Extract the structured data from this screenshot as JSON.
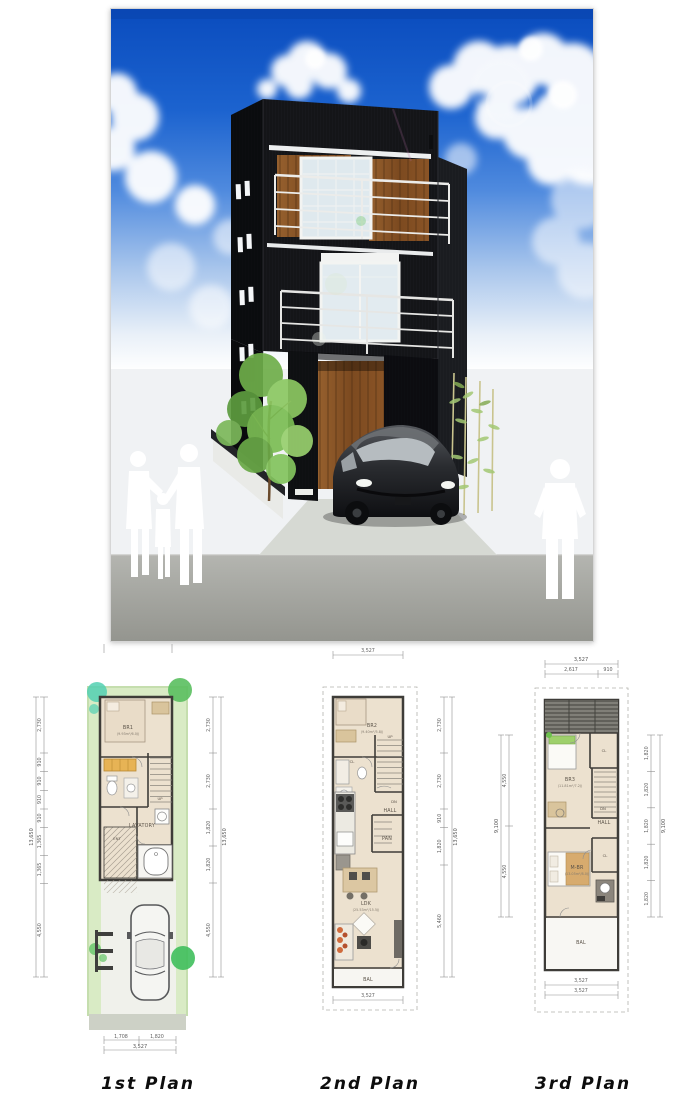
{
  "page": {
    "background": "#ffffff"
  },
  "rendering": {
    "subject": "three-story modern black house exterior with car and people silhouettes",
    "colors": {
      "sky_top": "#0a4cbe",
      "sky_mid": "#4f8ade",
      "building_black": "#17181c",
      "wood_accent": "#8c5426",
      "glass": "#dce8ee",
      "railing": "#ececea",
      "street_gray": "#a4a5a0",
      "foliage_green": "#7bbd54"
    }
  },
  "plans": [
    {
      "title": "1st Plan",
      "labels": {
        "br": "BR1",
        "br_size": "(9.93m²/6.0J)",
        "lavatory": "LAVATORY",
        "ent": "ENT",
        "up": "UP"
      },
      "dims": {
        "left": [
          "2,730",
          "910",
          "910",
          "910",
          "910",
          "1,365",
          "1,365",
          "4,550"
        ],
        "left_total": "13,650",
        "right": [
          "2,730",
          "2,730",
          "1,820",
          "1,820",
          "4,550"
        ],
        "right_total": "13,650",
        "bottom": [
          "1,708",
          "1,820"
        ],
        "bottom_total": "3,527"
      }
    },
    {
      "title": "2nd Plan",
      "labels": {
        "br": "BR2",
        "br_size": "(9.40m²/5.8J)",
        "cl": "CL",
        "up": "UP",
        "dn": "DN",
        "hall": "HALL",
        "pan": "PAN",
        "ldk": "LDK",
        "ldk_size": "(25.53m²/15.5J)",
        "bal": "BAL"
      },
      "dims": {
        "top": "3,527",
        "right": [
          "2,730",
          "2,730",
          "910",
          "1,820",
          "5,460"
        ],
        "right_total": "13,650",
        "bottom": "3,527"
      }
    },
    {
      "title": "3rd Plan",
      "labels": {
        "br": "BR3",
        "br_size": "(11.81m²/7.2J)",
        "cl_upper": "CL",
        "dn": "DN",
        "hall": "HALL",
        "mbr": "M-BR",
        "mbr_size": "(13.05m²/8.0J)",
        "cl_lower": "CL",
        "bal": "BAL"
      },
      "dims": {
        "top_total": "3,527",
        "top": [
          "2,617",
          "910"
        ],
        "left": [
          "4,550",
          "4,550"
        ],
        "left_total": "9,100",
        "right": [
          "1,820",
          "1,820",
          "1,820",
          "1,820",
          "1,820"
        ],
        "right_total": "9,100",
        "bottom": [
          "3,527",
          "3,527"
        ]
      }
    }
  ]
}
